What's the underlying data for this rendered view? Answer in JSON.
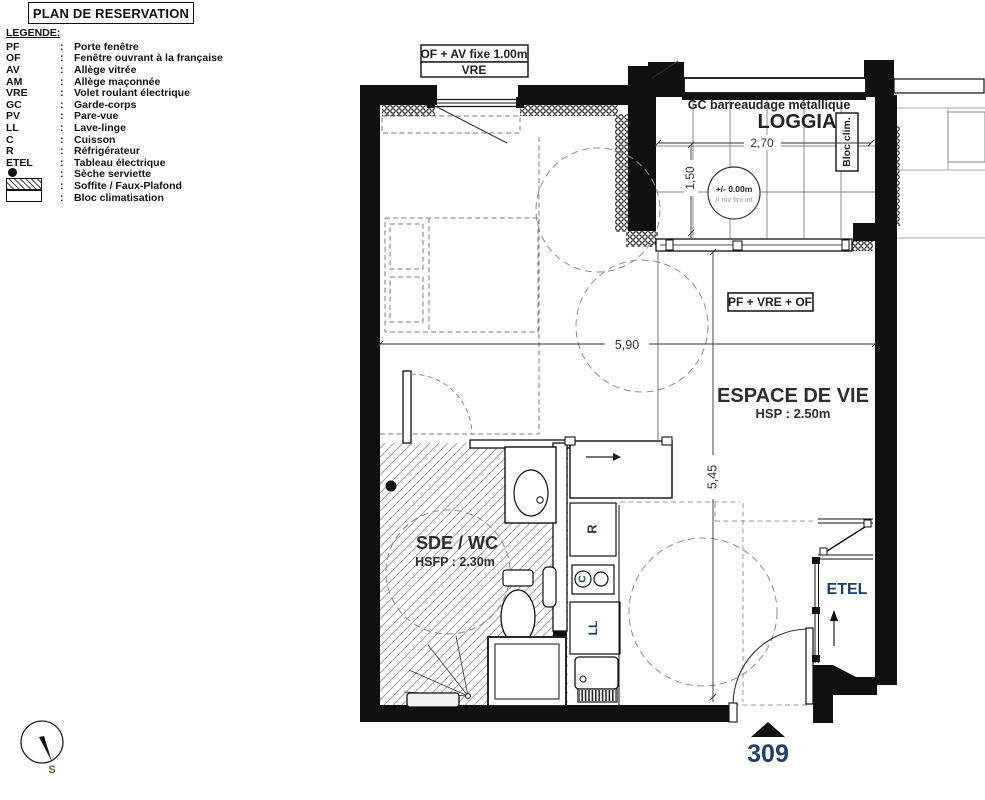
{
  "title": "PLAN DE RESERVATION",
  "legend": {
    "heading": "LEGENDE:",
    "sep": ":",
    "items": [
      {
        "abbr": "PF",
        "label": "Porte fenêtre"
      },
      {
        "abbr": "OF",
        "label": "Fenêtre ouvrant à la française"
      },
      {
        "abbr": "AV",
        "label": "Allège vitrée"
      },
      {
        "abbr": "AM",
        "label": "Allège maçonnée"
      },
      {
        "abbr": "VRE",
        "label": "Volet roulant électrique"
      },
      {
        "abbr": "GC",
        "label": "Garde-corps"
      },
      {
        "abbr": "PV",
        "label": "Pare-vue"
      },
      {
        "abbr": "LL",
        "label": "Lave-linge"
      },
      {
        "abbr": "C",
        "label": "Cuisson"
      },
      {
        "abbr": "R",
        "label": "Réfrigérateur"
      },
      {
        "abbr": "ETEL",
        "label": "Tableau électrique"
      },
      {
        "abbr": "",
        "label": "Sèche serviette"
      },
      {
        "abbr": "",
        "label": "Soffite / Faux-Plafond"
      },
      {
        "abbr": "",
        "label": "Bloc climatisation"
      }
    ]
  },
  "plan": {
    "window_box": {
      "line1": "OF + AV fixe 1.00m",
      "line2": "VRE"
    },
    "loggia": {
      "name": "LOGGIA",
      "railing_label": "GC barreaudage métallique",
      "width": "2,70",
      "depth": "1,50",
      "level": "+/- 0.00m",
      "level_note": "// niv fini int",
      "bloc_clim": "Bloc clim."
    },
    "living": {
      "name": "ESPACE DE VIE",
      "ceiling": "HSP : 2.50m",
      "door_label": "PF + VRE + OF"
    },
    "dims": {
      "width": "5,90",
      "height": "5,45"
    },
    "bathroom": {
      "name": "SDE / WC",
      "ceiling": "HSFP : 2.30m"
    },
    "kitchen": {
      "fridge": "R",
      "cooktop": "C",
      "washer": "LL"
    },
    "etel": "ETEL",
    "unit_number": "309",
    "compass_south": "S"
  },
  "colors": {
    "ink": "#111111",
    "navy": "#1f3f63",
    "dash": "#8c8c8c"
  }
}
